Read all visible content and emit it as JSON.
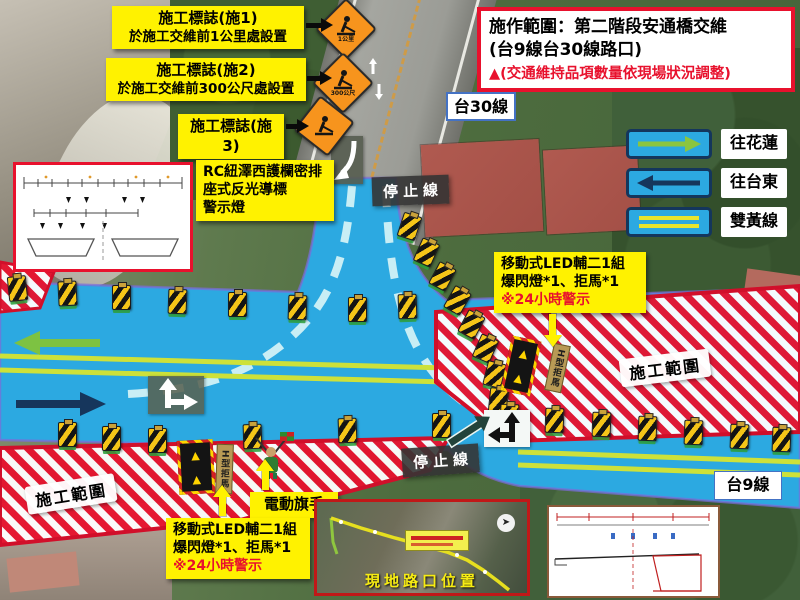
{
  "header": {
    "line1": "施作範圍：第二階段安通橋交維",
    "line2": "(台9線台30線路口)",
    "note": "▲(交通維持品項數量依現場狀況調整)"
  },
  "callouts": {
    "sign1": {
      "title": "施工標誌(施1)",
      "desc": "於施工交維前1公里處設置",
      "badge": "1公里"
    },
    "sign2": {
      "title": "施工標誌(施2)",
      "desc": "於施工交維前300公尺處設置",
      "badge": "300公尺"
    },
    "sign3": {
      "title": "施工標誌(施3)"
    },
    "rc_barrier": {
      "line1": "RC紐澤西護欄密排",
      "line2": "座式反光導標",
      "line3": "警示燈"
    },
    "led_right": {
      "line1": "移動式LED輔二1組",
      "line2": "爆閃燈*1、拒馬*1",
      "line3": "※24小時警示"
    },
    "led_bottom": {
      "line1": "移動式LED輔二1組",
      "line2": "爆閃燈*1、拒馬*1",
      "line3": "※24小時警示"
    },
    "flagman": "電動旗手"
  },
  "legend": {
    "items": [
      {
        "symbol": "arrow-right-green",
        "label": "往花蓮"
      },
      {
        "symbol": "arrow-left-navy",
        "label": "往台東"
      },
      {
        "symbol": "double-yellow-line",
        "label": "雙黃線"
      }
    ]
  },
  "road_labels": {
    "tai30": "台30線",
    "tai9": "台9線"
  },
  "map_labels": {
    "stop_line": "停止線",
    "work_zone": "施工範圍",
    "h_barrier": "H型拒馬"
  },
  "inset": {
    "caption": "現地路口位置"
  },
  "colors": {
    "accent_red": "#E8112D",
    "label_yellow": "#FFF200",
    "road_blue": "#2CA9E1",
    "lane_green": "#C8E63C",
    "navy": "#16365C",
    "cone_orange": "#F7941D"
  }
}
